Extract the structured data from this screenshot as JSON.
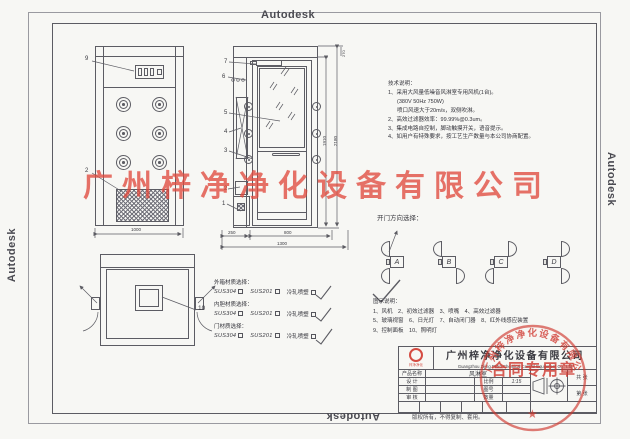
{
  "sheet": {
    "background": "#f7f7f4",
    "line_color": "#5c5c63"
  },
  "plot_stamp": {
    "label": "Autodesk"
  },
  "watermark": {
    "text": "广州梓净净化设备有限公司",
    "color": "#e04a3e"
  },
  "technical_notes": {
    "title": "技术说明：",
    "lines": [
      "1、采用大风量低噪音风淋室专用风机(1台)。",
      "(380V 50Hz 750W)",
      "喷口风速大于20m/s，双侧吹淋。",
      "2、高效过滤器效率：99.99%@0.3um。",
      "3、集成电路自控制，脚动触摸开关，语音提示。",
      "4、如用户有特殊要求，按工艺生产数量与本公司协商配置。"
    ]
  },
  "door_direction": {
    "title": "开门方向选择：",
    "options": [
      "A",
      "B",
      "C",
      "D"
    ],
    "selected": "A",
    "check": "✓",
    "arrow": "↑"
  },
  "legend": {
    "title": "图示说明：",
    "rows": [
      "1、风机　2、初效过滤器　3、喷嘴　4、高效过滤器",
      "5、玻璃视窗　6、日光灯　7、自动闭门器　8、红外线感应装置",
      "9、控制面板　10、照明灯"
    ]
  },
  "materials": {
    "check_glyph": "✓",
    "groups": [
      {
        "label": "外箱材质选择：",
        "options": [
          {
            "name": "SUS304",
            "checked": false
          },
          {
            "name": "SUS201",
            "checked": false
          },
          {
            "name": "冷轧喷塑",
            "checked": true
          }
        ]
      },
      {
        "label": "内胆材质选择：",
        "options": [
          {
            "name": "SUS304",
            "checked": false
          },
          {
            "name": "SUS201",
            "checked": false
          },
          {
            "name": "冷轧喷塑",
            "checked": true
          }
        ]
      },
      {
        "label": "门材质选择：",
        "options": [
          {
            "name": "SUS304",
            "checked": false
          },
          {
            "name": "SUS201",
            "checked": false
          },
          {
            "name": "冷轧喷塑",
            "checked": true
          }
        ]
      }
    ]
  },
  "dimensions": {
    "front_width": "1000",
    "depth_left": "250",
    "depth_door": "800",
    "depth_total": "1300",
    "height_door": "1910",
    "height_total": "2180",
    "top_section": "270"
  },
  "part_labels": {
    "control_panel": "9",
    "front_grille": "2",
    "side_stack": [
      "7",
      "6",
      "5",
      "4",
      "3",
      "2",
      "1"
    ],
    "ceiling_lamp": "10"
  },
  "title_block": {
    "logo_text": "梓净净化",
    "company_cn": "广州梓净净化设备有限公司",
    "company_en": "Guangzhou Zijing Petro Chemical Control Equipment Co., Ltd",
    "product_label": "产品名称",
    "product_value": "风淋室",
    "row_labels": [
      "设 计",
      "制 图",
      "审 核"
    ],
    "scale_label": "比例",
    "scale_value": "1:15",
    "drawing_no_label": "图号",
    "qty_label": "数量",
    "sheets_total_label": "共 张",
    "sheet_no_label": "第 张",
    "copyright": "版权所有，不得复制、套用。"
  },
  "seal": {
    "ring_text": "广州梓净净化设备有限公司",
    "banner": "合同专用章",
    "star": "★"
  }
}
